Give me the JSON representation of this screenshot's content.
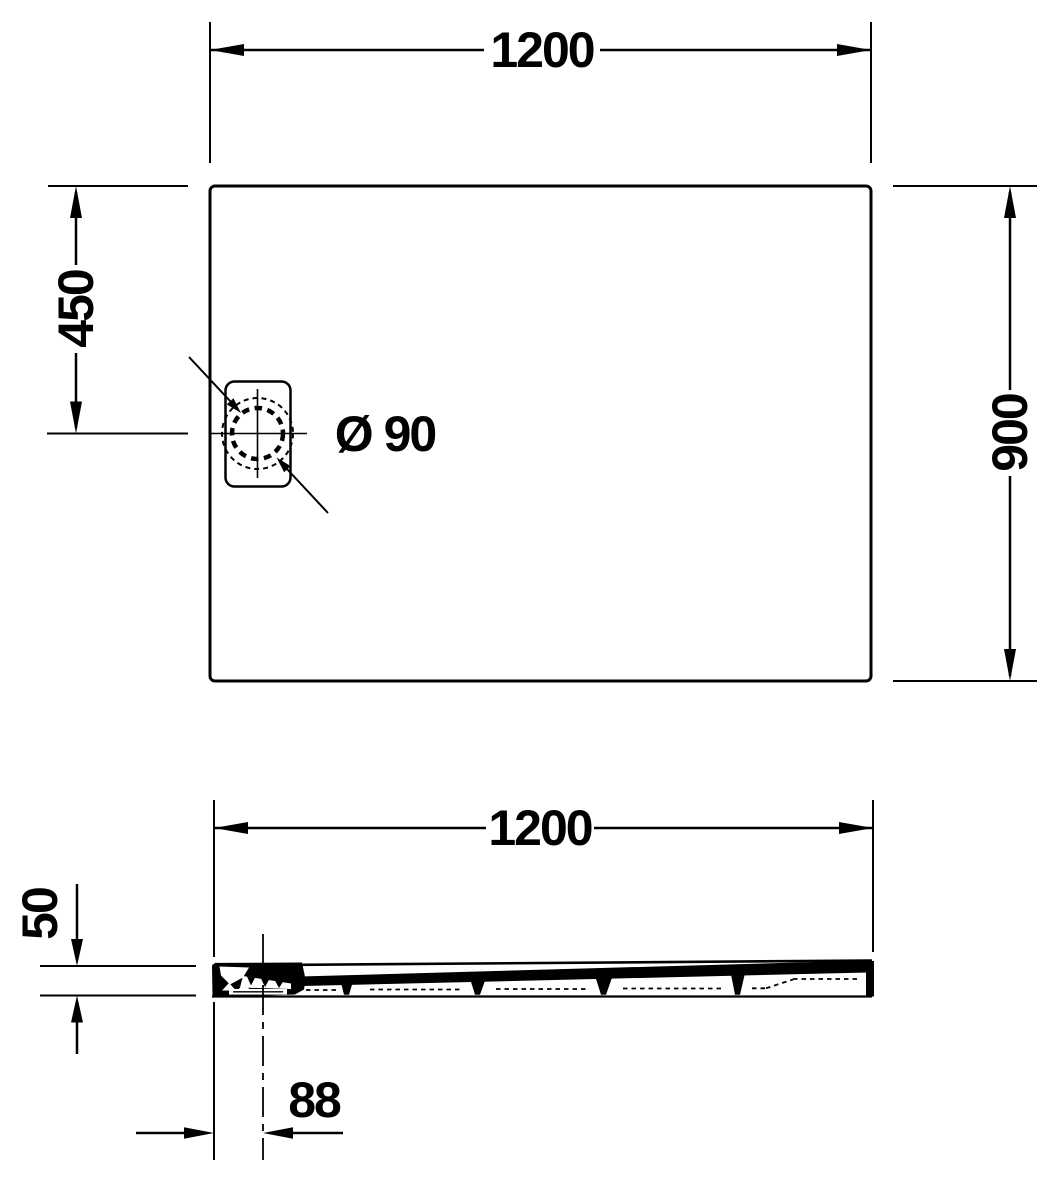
{
  "drawing": {
    "type": "technical-dimension-drawing",
    "views": [
      "top-view",
      "side-section-view"
    ]
  },
  "top_view": {
    "width_label": "1200",
    "drain_offset_label": "450",
    "depth_label": "900",
    "drain_diameter_label": "Ø 90"
  },
  "side_view": {
    "width_label": "1200",
    "height_label": "50",
    "drain_offset_label": "88"
  },
  "colors": {
    "ink": "#000000",
    "paper": "#ffffff"
  }
}
